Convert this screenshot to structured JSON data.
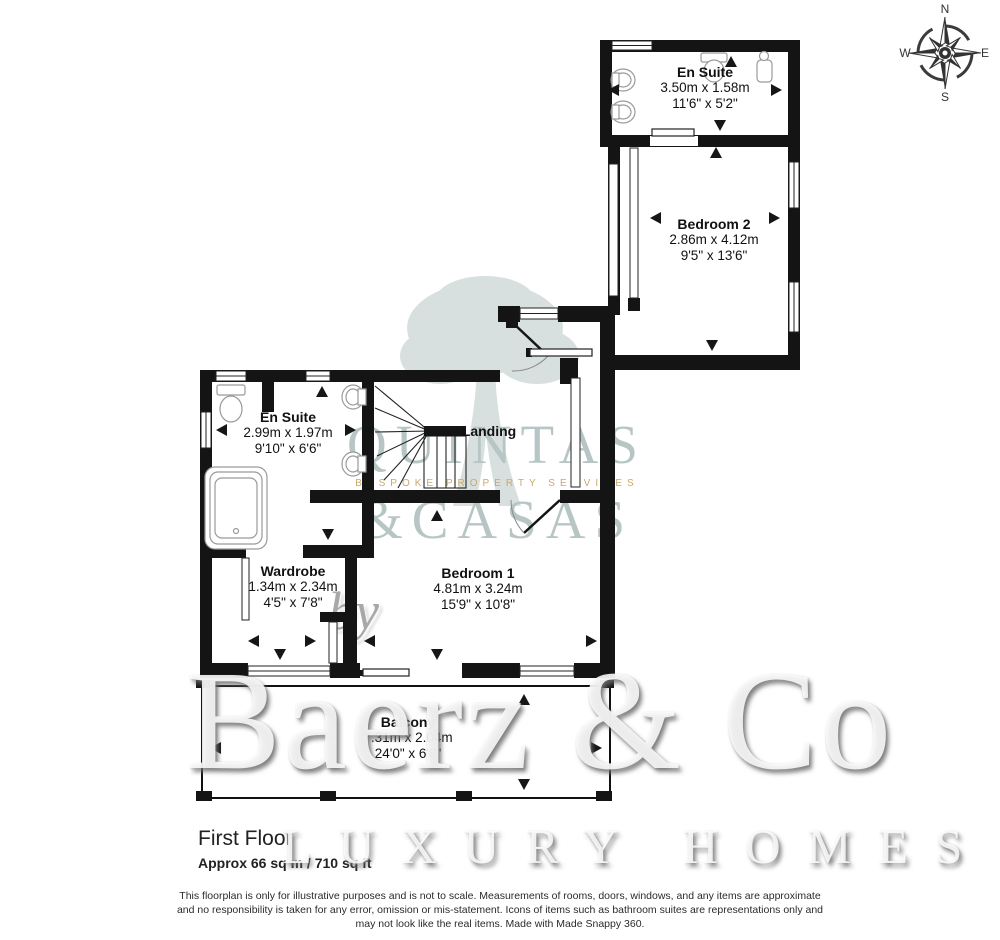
{
  "title": {
    "floor": "First Floor",
    "area": "Approx 66 sq m / 710 sq ft"
  },
  "compass": {
    "north": "N",
    "east": "E",
    "south": "S",
    "west": "W"
  },
  "rooms": [
    {
      "name": "En Suite",
      "metric": "3.50m x 1.58m",
      "imperial": "11'6\" x 5'2\""
    },
    {
      "name": "Bedroom 2",
      "metric": "2.86m x 4.12m",
      "imperial": "9'5\" x 13'6\""
    },
    {
      "name": "En Suite",
      "metric": "2.99m x 1.97m",
      "imperial": "9'10\" x 6'6\""
    },
    {
      "name": "Landing"
    },
    {
      "name": "Wardrobe",
      "metric": "1.34m x 2.34m",
      "imperial": "4'5\" x 7'8\""
    },
    {
      "name": "Bedroom 1",
      "metric": "4.81m x 3.24m",
      "imperial": "15'9\" x 10'8\""
    },
    {
      "name": "Balcony",
      "metric": "7.31m x 2.04m",
      "imperial": "24'0\" x 6'8\""
    }
  ],
  "watermarks": {
    "agency_line1": "QUINTAS",
    "agency_line2": "&CASAS",
    "agency_tagline": "BESPOKE PROPERTY SERVICES",
    "by": "by",
    "brand": "Baerz & Co",
    "brand_sub": "LUXURY HOMES"
  },
  "footer": {
    "line1": "This floorplan is only for illustrative purposes and is not to scale. Measurements of rooms, doors, windows, and any items are approximate",
    "line2": "and no responsibility is taken for any error, omission or mis-statement. Icons of items such as bathroom suites are representations only and",
    "line3": "may not look like the real items. Made with Made Snappy 360."
  },
  "colors": {
    "wall": "#141414",
    "watermark_teal": "#b7c6c4",
    "watermark_gold": "#c9a96a"
  }
}
